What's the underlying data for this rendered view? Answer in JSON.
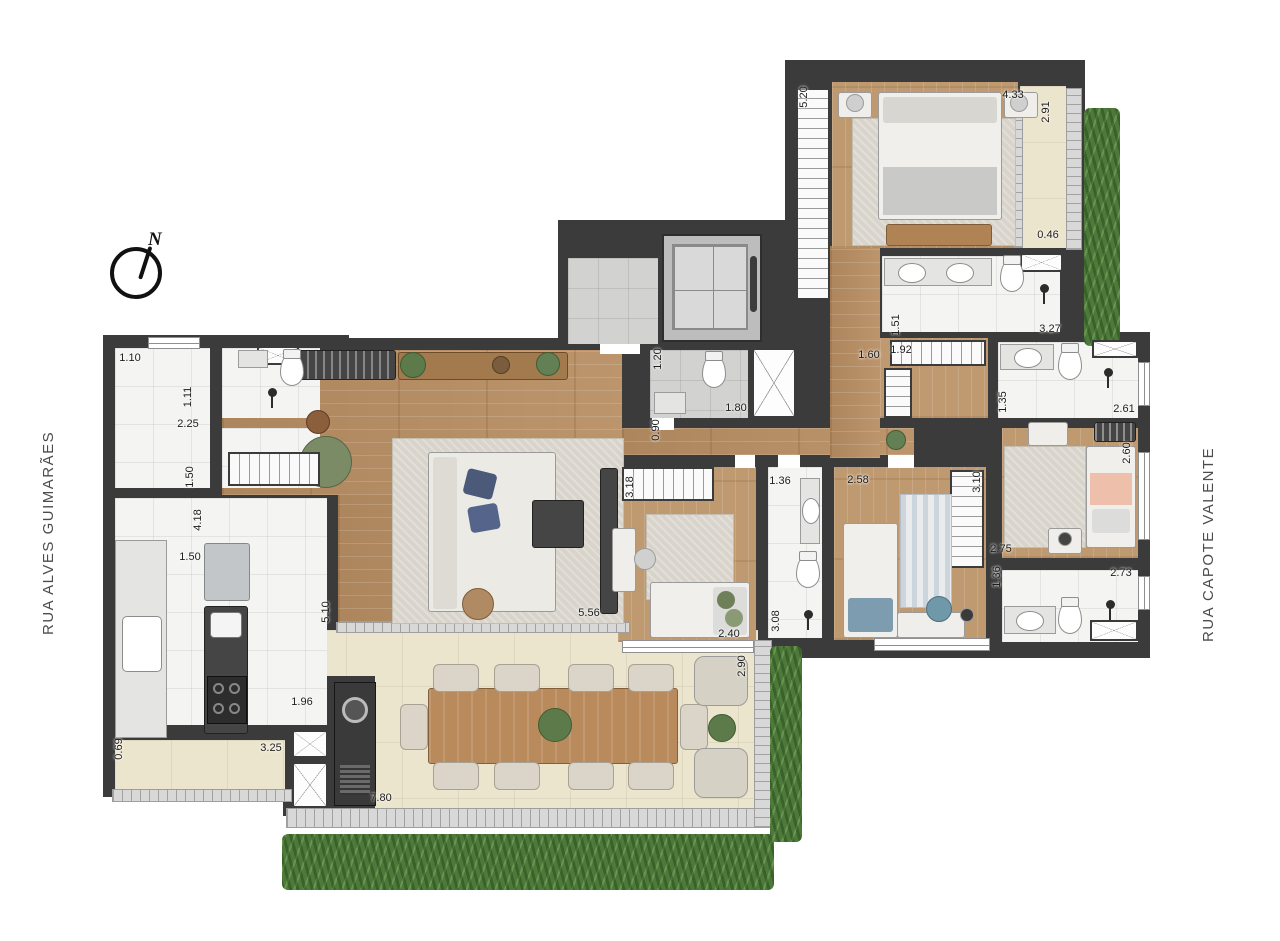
{
  "title": "apartment-floor-plan",
  "streets": {
    "left": "RUA ALVES GUIMARÃES",
    "right": "RUA CAPOTE VALENTE"
  },
  "compass": {
    "label": "N"
  },
  "colors": {
    "wall": "#3b3b3b",
    "wood_floor": "#b78d62",
    "wood_floor_light": "#bf9a70",
    "tile": "#f4f4f2",
    "gray_tile": "#d2d2d1",
    "terrace": "#ece5cd",
    "grass": "#4d7a3b",
    "accent_green_chair": "#7b8b66",
    "accent_teal_chair": "#6f98a8",
    "accent_salmon_bed": "#eec0ac",
    "accent_blue_pillow": "#4a5a78"
  },
  "dimensions": [
    {
      "text": "1.10",
      "x": 130,
      "y": 358,
      "vertical": false
    },
    {
      "text": "1.11",
      "x": 188,
      "y": 397,
      "vertical": true
    },
    {
      "text": "2.25",
      "x": 188,
      "y": 424,
      "vertical": false
    },
    {
      "text": "1.50",
      "x": 190,
      "y": 477,
      "vertical": true
    },
    {
      "text": "4.18",
      "x": 198,
      "y": 520,
      "vertical": true
    },
    {
      "text": "1.50",
      "x": 190,
      "y": 557,
      "vertical": false
    },
    {
      "text": "5.10",
      "x": 326,
      "y": 612,
      "vertical": true
    },
    {
      "text": "0.69",
      "x": 119,
      "y": 749,
      "vertical": true
    },
    {
      "text": "3.25",
      "x": 271,
      "y": 748,
      "vertical": false
    },
    {
      "text": "1.96",
      "x": 302,
      "y": 702,
      "vertical": false
    },
    {
      "text": "7.80",
      "x": 381,
      "y": 798,
      "vertical": false
    },
    {
      "text": "5.56",
      "x": 589,
      "y": 613,
      "vertical": false
    },
    {
      "text": "2.40",
      "x": 729,
      "y": 634,
      "vertical": false
    },
    {
      "text": "2.90",
      "x": 742,
      "y": 666,
      "vertical": true
    },
    {
      "text": "3.08",
      "x": 776,
      "y": 621,
      "vertical": true
    },
    {
      "text": "1.36",
      "x": 780,
      "y": 481,
      "vertical": false
    },
    {
      "text": "3.18",
      "x": 630,
      "y": 487,
      "vertical": true
    },
    {
      "text": "0.90",
      "x": 656,
      "y": 430,
      "vertical": true
    },
    {
      "text": "1.20",
      "x": 658,
      "y": 359,
      "vertical": true
    },
    {
      "text": "1.80",
      "x": 736,
      "y": 408,
      "vertical": false
    },
    {
      "text": "2.58",
      "x": 858,
      "y": 480,
      "vertical": false
    },
    {
      "text": "3.10",
      "x": 977,
      "y": 482,
      "vertical": true
    },
    {
      "text": "2.75",
      "x": 1001,
      "y": 549,
      "vertical": false
    },
    {
      "text": "1.36",
      "x": 997,
      "y": 577,
      "vertical": true
    },
    {
      "text": "2.73",
      "x": 1121,
      "y": 573,
      "vertical": false
    },
    {
      "text": "2.60",
      "x": 1127,
      "y": 453,
      "vertical": true
    },
    {
      "text": "2.61",
      "x": 1124,
      "y": 409,
      "vertical": false
    },
    {
      "text": "1.35",
      "x": 1003,
      "y": 402,
      "vertical": true
    },
    {
      "text": "1.92",
      "x": 901,
      "y": 350,
      "vertical": false
    },
    {
      "text": "1.60",
      "x": 869,
      "y": 355,
      "vertical": false
    },
    {
      "text": "1.51",
      "x": 896,
      "y": 325,
      "vertical": true
    },
    {
      "text": "3.27",
      "x": 1050,
      "y": 329,
      "vertical": false
    },
    {
      "text": "5.20",
      "x": 804,
      "y": 97,
      "vertical": true
    },
    {
      "text": "4.33",
      "x": 1013,
      "y": 95,
      "vertical": false
    },
    {
      "text": "2.91",
      "x": 1046,
      "y": 112,
      "vertical": true
    },
    {
      "text": "0.46",
      "x": 1048,
      "y": 235,
      "vertical": false
    }
  ]
}
